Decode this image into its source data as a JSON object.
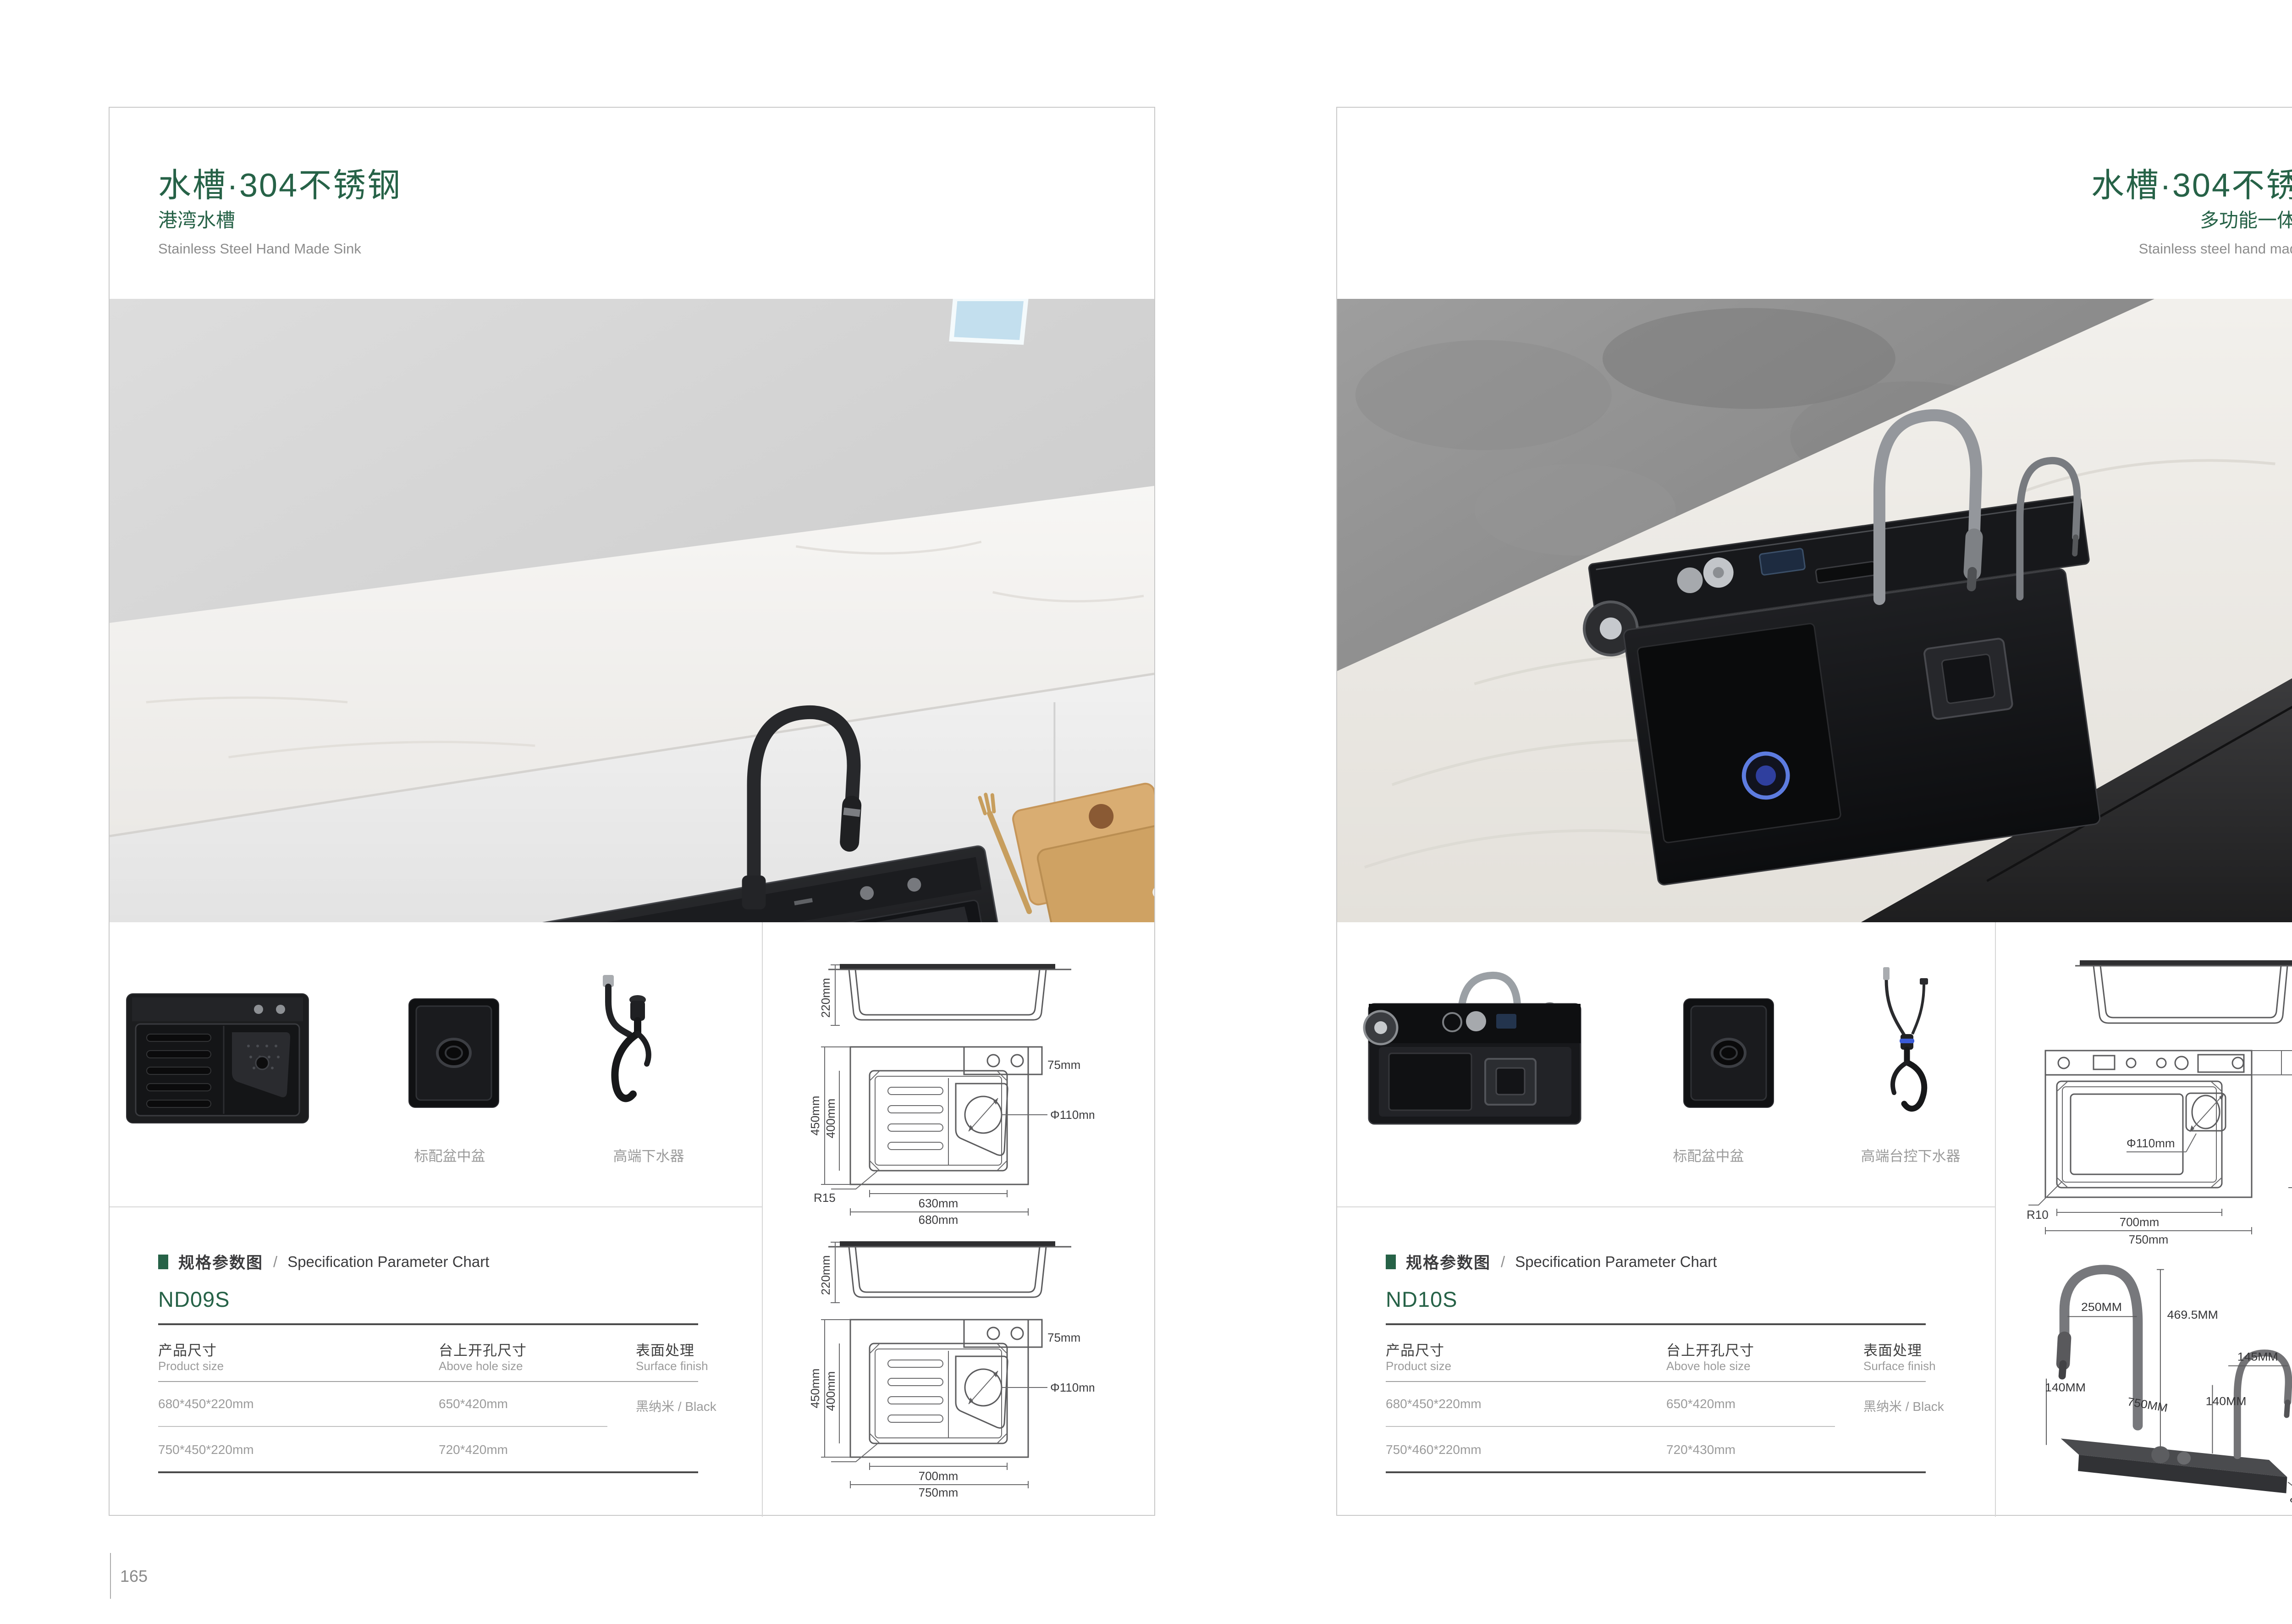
{
  "colors": {
    "accent_green": "#266247",
    "body_text": "#3b3b3d",
    "muted_text": "#9b9b9b"
  },
  "left": {
    "page_number": "165",
    "header": {
      "title": "水槽·304不锈钢",
      "subtitle": "港湾水槽",
      "subtitle_en": "Stainless Steel Hand Made Sink"
    },
    "thumbnails": {
      "basin_caption": "标配盆中盆",
      "drain_caption": "高端下水器"
    },
    "spec": {
      "section_cn": "规格参数图",
      "section_sep": "/",
      "section_en": "Specification Parameter Chart",
      "model": "ND09S",
      "columns": [
        {
          "cn": "产品尺寸",
          "en": "Product size"
        },
        {
          "cn": "台上开孔尺寸",
          "en": "Above hole size"
        },
        {
          "cn": "表面处理",
          "en": "Surface finish"
        }
      ],
      "rows": [
        [
          "680*450*220mm",
          "650*420mm",
          "黑纳米 / Black"
        ],
        [
          "750*450*220mm",
          "720*420mm",
          ""
        ]
      ]
    },
    "drawing1": {
      "height": "220mm",
      "depth_outer": "450mm",
      "depth_inner": "400mm",
      "deck": "75mm",
      "drain": "Φ110mm",
      "radius": "R15",
      "width_inner": "630mm",
      "width_outer": "680mm"
    },
    "drawing2": {
      "height": "220mm",
      "depth_outer": "450mm",
      "depth_inner": "400mm",
      "deck": "75mm",
      "drain": "Φ110mm",
      "width_inner": "700mm",
      "width_outer": "750mm"
    }
  },
  "right": {
    "page_number": "166",
    "header": {
      "title": "水槽·304不锈钢",
      "subtitle": "多功能一体水槽",
      "subtitle_en": "Stainless steel hand made sink"
    },
    "thumbnails": {
      "basin_caption": "标配盆中盆",
      "drain_caption": "高端台控下水器"
    },
    "spec": {
      "section_cn": "规格参数图",
      "section_sep": "/",
      "section_en": "Specification Parameter Chart",
      "model": "ND10S",
      "columns": [
        {
          "cn": "产品尺寸",
          "en": "Product size"
        },
        {
          "cn": "台上开孔尺寸",
          "en": "Above hole size"
        },
        {
          "cn": "表面处理",
          "en": "Surface finish"
        }
      ],
      "rows": [
        [
          "680*450*220mm",
          "650*420mm",
          "黑纳米 / Black"
        ],
        [
          "750*460*220mm",
          "720*430mm",
          ""
        ]
      ]
    },
    "drawing1": {
      "height": "220mm",
      "deck": "80mm",
      "depth_inner": "355mm",
      "depth_outer": "460mm",
      "drain": "Φ110mm",
      "radius": "R10",
      "width_inner": "700mm",
      "width_outer": "750mm"
    },
    "faucet": {
      "reach": "250MM",
      "height": "469.5MM",
      "clearance": "140MM",
      "base_length": "750MM",
      "small_reach": "145MM",
      "small_clearance": "140MM",
      "small_height": "225MM",
      "base_height": "40MM",
      "base_depth": "80MM"
    }
  }
}
